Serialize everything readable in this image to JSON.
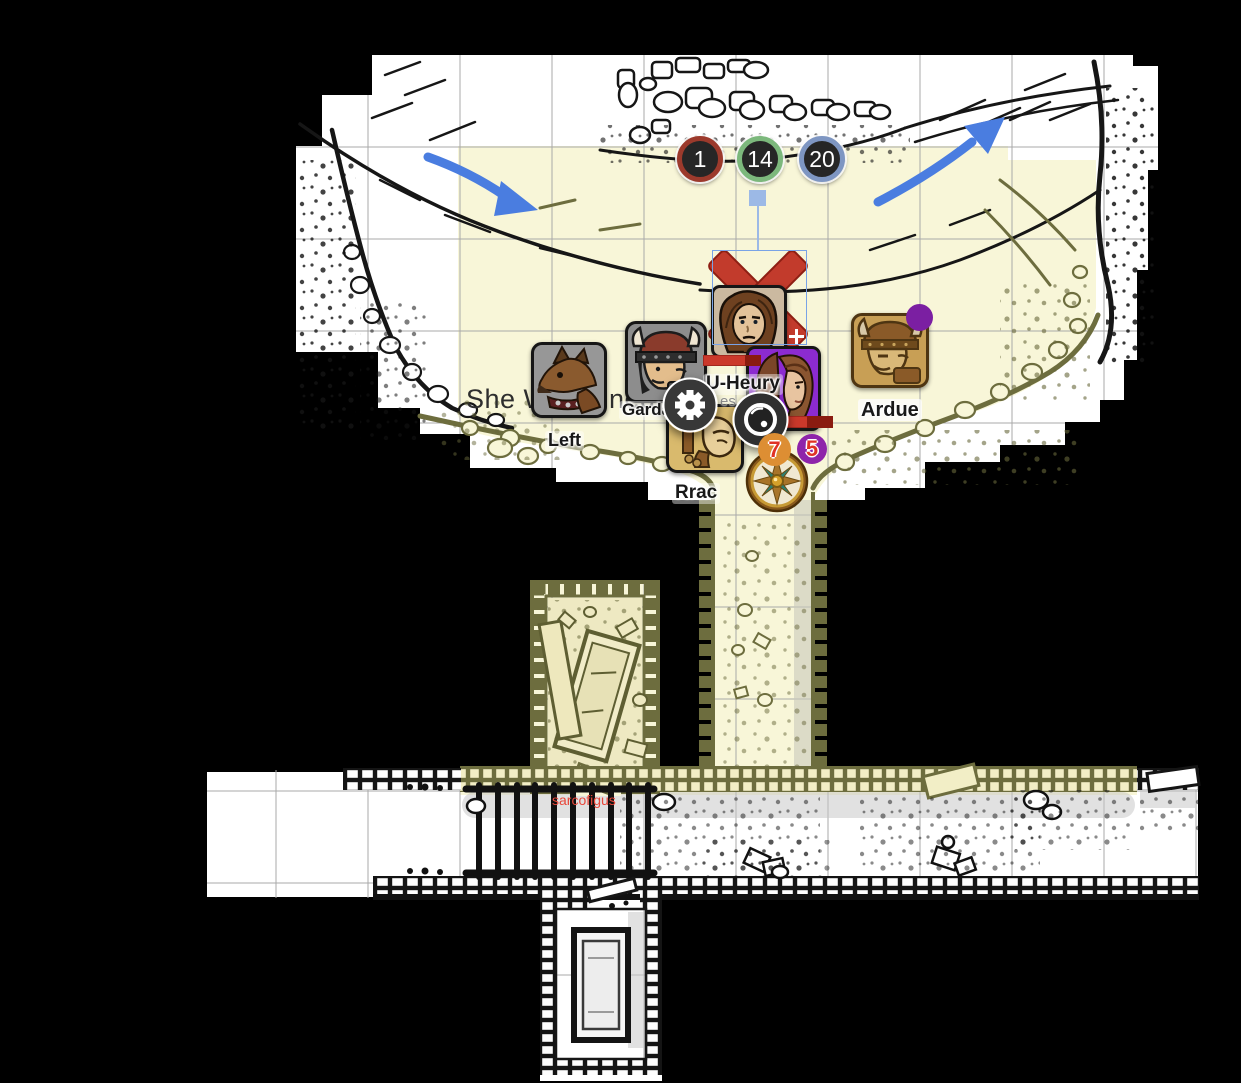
{
  "counters": [
    {
      "label": "1",
      "ring_color": "#9c3a2c"
    },
    {
      "label": "14",
      "ring_color": "#7cb87c"
    },
    {
      "label": "20",
      "ring_color": "#7e96c2"
    }
  ],
  "labels": {
    "u_heury": "U-Heury",
    "garda": "Garda",
    "left": "Left",
    "ardue": "Ardue",
    "rrac": "Rrac",
    "obscured_fragment": "es"
  },
  "annotations": {
    "scribble_left": "She W",
    "scribble_right": "ned the",
    "sarcophagus_note": "sarcofigus"
  },
  "badges": [
    {
      "value": "7",
      "color": "#dd8e33"
    },
    {
      "value": "5",
      "color": "#8e24aa"
    }
  ],
  "icons": {
    "gear": "gear-icon",
    "lens": "lens-icon",
    "compass": "compass-rose",
    "rotate_handle": "rotate-handle"
  },
  "colors": {
    "floor": "#f8f6d8",
    "wall_olive": "#6d6d3e",
    "arrow_blue": "#4a7de0",
    "selection_blue": "#9cb9e6",
    "health_red": "#cb392b",
    "token_gray": "#8d8d8d",
    "token_purple": "#8c2bd0"
  }
}
